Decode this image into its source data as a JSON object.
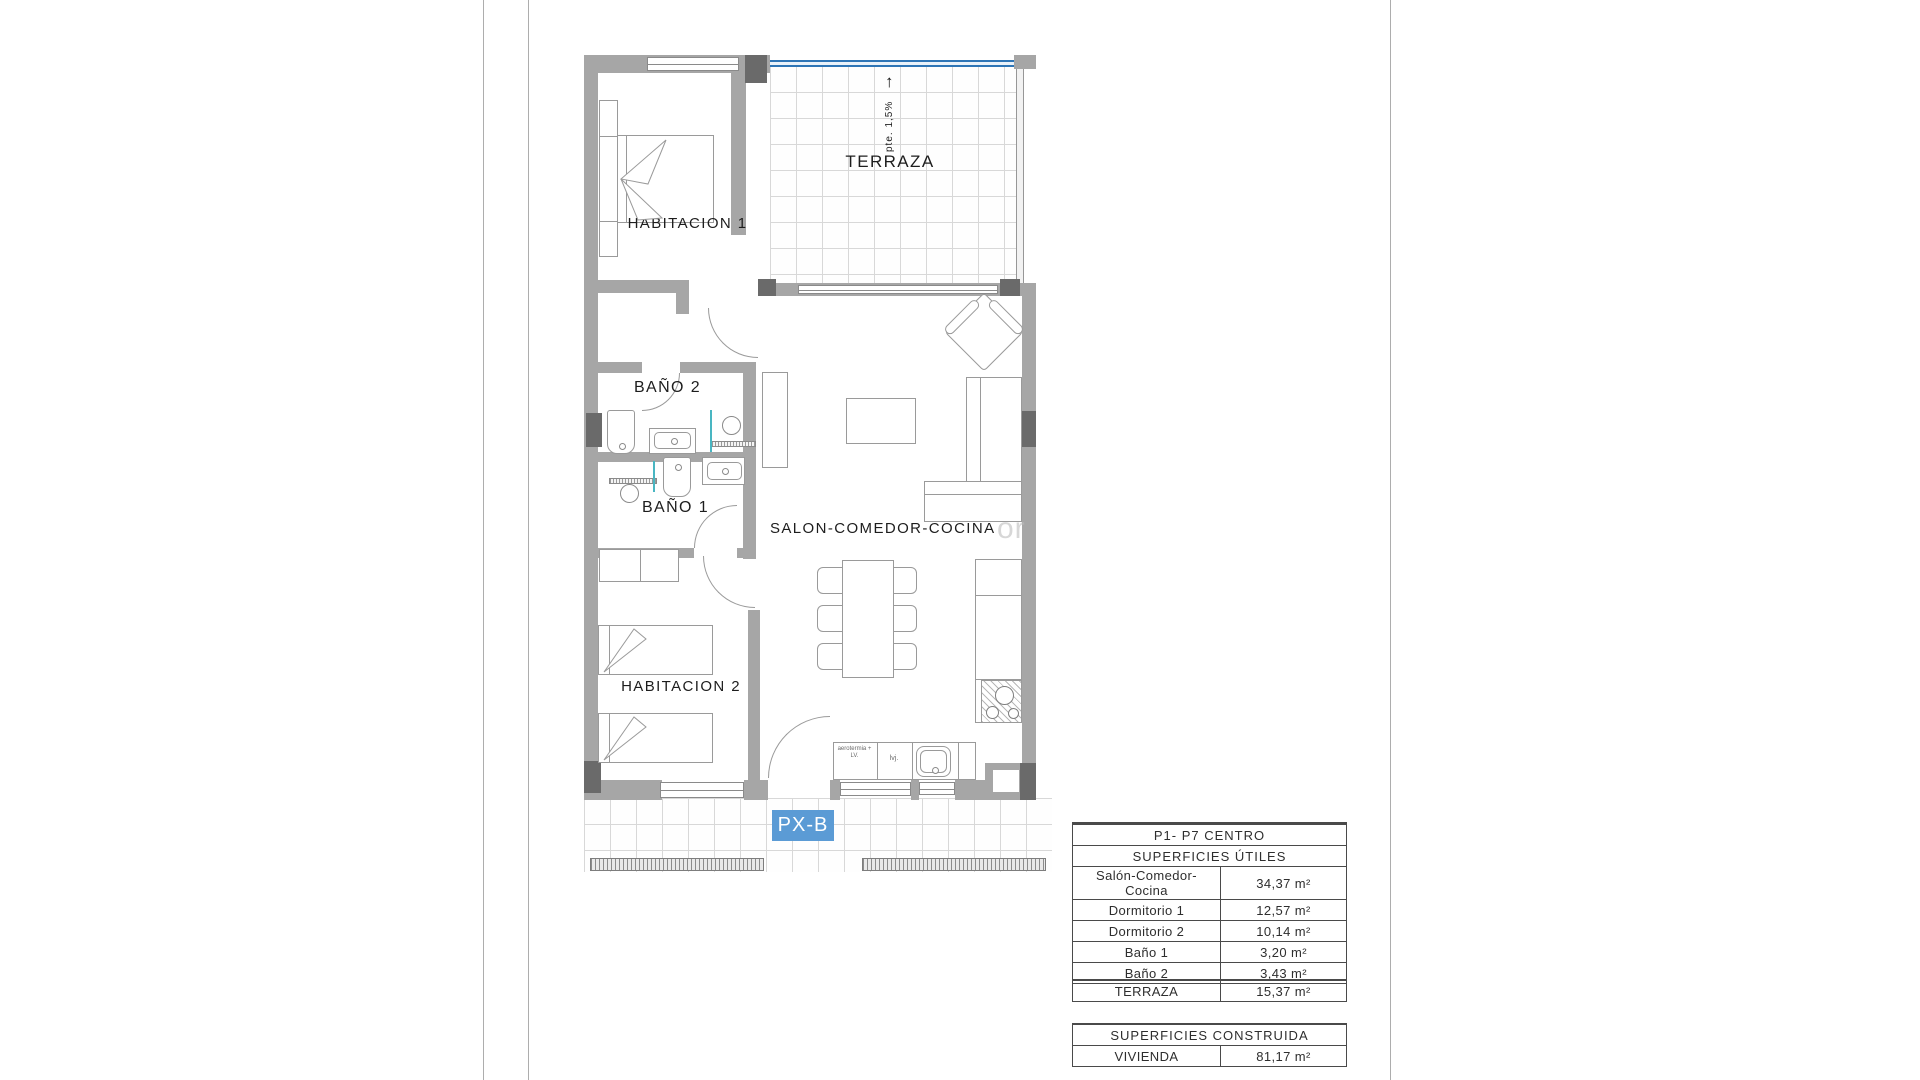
{
  "page": {
    "watermark": "or"
  },
  "plan": {
    "badge": "PX-B",
    "labels": {
      "terraza": "TERRAZA",
      "habitacion1": "HABITACION 1",
      "habitacion2": "HABITACION 2",
      "bano2": "BAÑO 2",
      "bano1": "BAÑO 1",
      "salon": "SALON-COMEDOR-COCINA",
      "slope": "pte. 1,5%",
      "slope_arrow": "↑",
      "kitchen_small_1": "aerotermia + LV.",
      "kitchen_small_2": "lvj."
    }
  },
  "tables": {
    "header": "P1- P7 CENTRO",
    "useful": {
      "title": "SUPERFICIES ÚTILES",
      "rows": [
        {
          "label": "Salón-Comedor-Cocina",
          "value": "34,37 m²"
        },
        {
          "label": "Dormitorio 1",
          "value": "12,57 m²"
        },
        {
          "label": "Dormitorio 2",
          "value": "10,14 m²"
        },
        {
          "label": "Baño 1",
          "value": "3,20 m²"
        },
        {
          "label": "Baño 2",
          "value": "3,43 m²"
        }
      ]
    },
    "terrace": {
      "label": "TERRAZA",
      "value": "15,37 m²"
    },
    "built": {
      "title": "SUPERFICIES CONSTRUIDA",
      "rows": [
        {
          "label": "VIVIENDA",
          "value": "81,17 m²"
        }
      ]
    }
  },
  "colors": {
    "accent_blue": "#5b9bd5",
    "glass_blue": "#2e75b6",
    "wall_gray": "#a6a6a6",
    "pillar_gray": "#6a6a6a",
    "teal": "#49b6c2"
  }
}
